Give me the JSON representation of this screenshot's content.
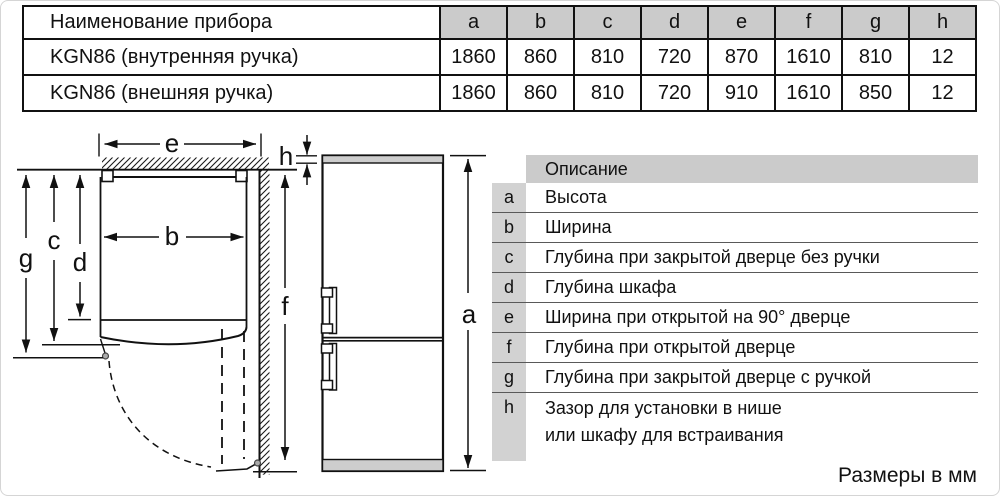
{
  "dimensions_table": {
    "name_header": "Наименование прибора",
    "columns": [
      "a",
      "b",
      "c",
      "d",
      "e",
      "f",
      "g",
      "h"
    ],
    "rows": [
      {
        "name": "KGN86 (внутренняя ручка)",
        "values": [
          "1860",
          "860",
          "810",
          "720",
          "870",
          "1610",
          "810",
          "12"
        ]
      },
      {
        "name": "KGN86 (внешняя ручка)",
        "values": [
          "1860",
          "860",
          "810",
          "720",
          "910",
          "1610",
          "850",
          "12"
        ]
      }
    ]
  },
  "legend_table": {
    "header": "Описание",
    "rows": [
      {
        "key": "a",
        "lines": [
          "Высота"
        ]
      },
      {
        "key": "b",
        "lines": [
          "Ширина"
        ]
      },
      {
        "key": "c",
        "lines": [
          "Глубина при закрытой дверце без ручки"
        ]
      },
      {
        "key": "d",
        "lines": [
          "Глубина шкафа"
        ]
      },
      {
        "key": "e",
        "lines": [
          "Ширина при открытой на 90° дверце"
        ]
      },
      {
        "key": "f",
        "lines": [
          "Глубина при открытой дверце"
        ]
      },
      {
        "key": "g",
        "lines": [
          "Глубина при закрытой дверце с ручкой"
        ]
      },
      {
        "key": "h",
        "lines": [
          "Зазор для установки в нише",
          "или шкафу для встраивания"
        ]
      }
    ]
  },
  "diagram": {
    "labels": {
      "a": "a",
      "b": "b",
      "c": "c",
      "d": "d",
      "e": "e",
      "f": "f",
      "g": "g",
      "h": "h"
    }
  },
  "footer_note": "Размеры в мм",
  "colors": {
    "table_header_gray": "#cbcbcb",
    "legend_key_gray": "#d2d2d2",
    "fridge_strip_gray": "#cdcdcd",
    "line_color": "#111111"
  }
}
